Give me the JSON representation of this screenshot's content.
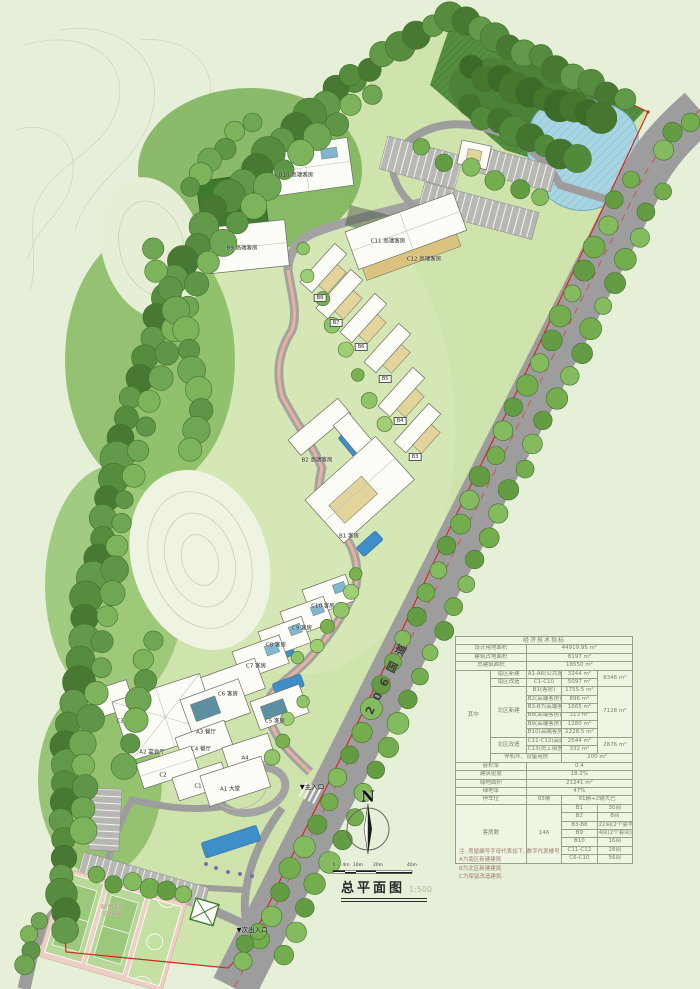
{
  "title_block": {
    "title": "总平面图",
    "scale_text": "1:500"
  },
  "north": {
    "label": "N"
  },
  "road": {
    "name": "206国道"
  },
  "entrances": {
    "main": "▼主入口",
    "secondary": "▼次出入口"
  },
  "scale_bar": {
    "labels": [
      "0",
      "4m",
      "10m",
      "20m",
      "40m"
    ]
  },
  "misc": {
    "temp_parking_1": "临时停车区",
    "temp_parking_2": "可停30辆"
  },
  "buildings": [
    {
      "label": "B10 高端客房"
    },
    {
      "label": "B9 高端客房"
    },
    {
      "label": "C11 高端客房"
    },
    {
      "label": "C12 高端客房"
    },
    {
      "label": "B8"
    },
    {
      "label": "B7"
    },
    {
      "label": "B6"
    },
    {
      "label": "B5"
    },
    {
      "label": "B4"
    },
    {
      "label": "B3"
    },
    {
      "label": "B2 高端客房"
    },
    {
      "label": "B1 客房"
    },
    {
      "label": "C10 客房"
    },
    {
      "label": "C9 客房"
    },
    {
      "label": "C8 客房"
    },
    {
      "label": "C7 客房"
    },
    {
      "label": "C6 客房"
    },
    {
      "label": "C5 客房"
    },
    {
      "label": "A3 餐厅"
    },
    {
      "label": "C4 餐厅"
    },
    {
      "label": "A2 宴会厅"
    },
    {
      "label": "A4"
    },
    {
      "label": "C3"
    },
    {
      "label": "C2"
    },
    {
      "label": "C1"
    },
    {
      "label": "A1 大堂"
    }
  ],
  "table": {
    "title": "经济技术指标",
    "r_site": {
      "label": "设计用地面积",
      "value": "44919.95 m²"
    },
    "r_footprint": {
      "label": "建筑占地面积",
      "value": "8197 m²"
    },
    "r_gfa": {
      "label": "总建筑面积",
      "value": "18550 m²"
    },
    "breakdown_label": "其中",
    "south_new": {
      "name": "南区新建",
      "item": "A1-A6(公共服务)",
      "value": "3244 m²"
    },
    "south_reno": {
      "name": "南区改造",
      "item": "C1-C10",
      "value": "5097 m²"
    },
    "south_subtotal": "8346 m²",
    "north_new": {
      "name": "北区新建",
      "subtotal": "7128 m²",
      "items": [
        {
          "label": "B1(客房)",
          "value": "1755.5 m²"
        },
        {
          "label": "B2(高端客房)",
          "value": "896 m²"
        },
        {
          "label": "B3-B7(高端客房)",
          "value": "1665 m²"
        },
        {
          "label": "B8(高端客房)",
          "value": "313 m²"
        },
        {
          "label": "B9(高端客房)",
          "value": "1280 m²"
        },
        {
          "label": "B10(高端客房)",
          "value": "1228.5 m²"
        }
      ]
    },
    "north_reno": {
      "name": "北区改造",
      "subtotal": "2876 m²",
      "items": [
        {
          "label": "C11-C12(高端客房)",
          "value": "2544 m²"
        },
        {
          "label": "C13(员工宿舍)",
          "value": "332 m²"
        }
      ]
    },
    "heli": {
      "label": "停机坪、设备用房",
      "value": "200 m²"
    },
    "r_far": {
      "label": "容积率",
      "value": "0.4"
    },
    "r_density": {
      "label": "建筑密度",
      "value": "18.2%"
    },
    "r_green_area": {
      "label": "绿地面积",
      "value": "21241 m²"
    },
    "r_green_rate": {
      "label": "绿地率",
      "value": "47%"
    },
    "r_parking": {
      "label": "停车位",
      "count": "93辆",
      "detail": "91辆+2辆大巴"
    },
    "rooms": {
      "label": "客房数",
      "total": "146",
      "items": [
        {
          "label": "B1",
          "value": "30间"
        },
        {
          "label": "B2",
          "value": "8间"
        },
        {
          "label": "B3-B8",
          "value": "22间(2个豪华套间)"
        },
        {
          "label": "B9",
          "value": "4间(2个套间)"
        },
        {
          "label": "B10",
          "value": "16间"
        },
        {
          "label": "C11-C12",
          "value": "28间"
        },
        {
          "label": "C6-C10",
          "value": "56间"
        }
      ]
    }
  },
  "notes": {
    "line1": "注: 房屋编号字母代表如下, 数字代表楼号",
    "line2": "A为南区新建建筑",
    "line3": "B为北区新建建筑",
    "line4": "C为保留改造建筑"
  },
  "colors": {
    "boundary_red": "#cf2b20",
    "road_gray": "#9d9d9d",
    "water_blue": "#a9d5e3",
    "forest_green": "#4d8a39",
    "pool_blue": "#3e8fc9"
  }
}
